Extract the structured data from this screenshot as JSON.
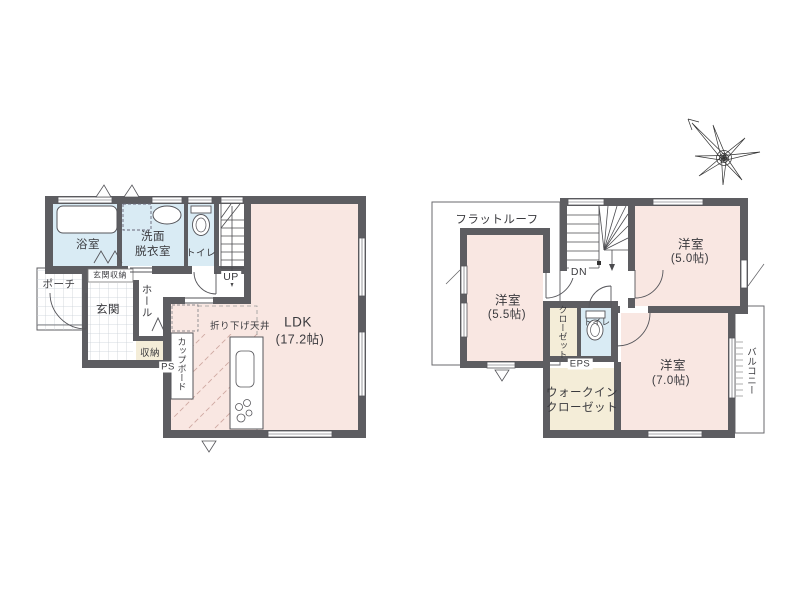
{
  "palette": {
    "room_pink": "#f9e7e2",
    "wet_blue": "#d9ebf4",
    "closet_beige": "#f4edd8",
    "wall_gray": "#5d5d61",
    "line_dark": "#4a4a4e",
    "text": "#3a3a3e"
  },
  "floor1": {
    "bath_label": "浴室",
    "washroom_line1": "洗面",
    "washroom_line2": "脱衣室",
    "toilet_label": "トイレ",
    "stairs_label": "UP",
    "entrance_storage_label": "玄関収納",
    "porch_label": "ポーチ",
    "entrance_label": "玄関",
    "hall_label": "ホール",
    "storage_label": "収納",
    "cupboard_label": "カップボード",
    "ps_label": "PS",
    "lowered_ceiling_label": "折り下げ天井",
    "ldk_name": "LDK",
    "ldk_size": "(17.2帖)"
  },
  "floor2": {
    "flat_roof_label": "フラットルーフ",
    "stairs_label": "DN",
    "bedroom_a_name": "洋室",
    "bedroom_a_size": "(5.5帖)",
    "bedroom_b_name": "洋室",
    "bedroom_b_size": "(5.0帖)",
    "bedroom_c_name": "洋室",
    "bedroom_c_size": "(7.0帖)",
    "closet_col1": "クロー",
    "closet_col2": "ゼット",
    "toilet_label": "トイレ",
    "eps_label": "EPS",
    "wic_line1": "ウォークイン",
    "wic_line2": "クローゼット",
    "balcony_label": "バルコニー"
  }
}
